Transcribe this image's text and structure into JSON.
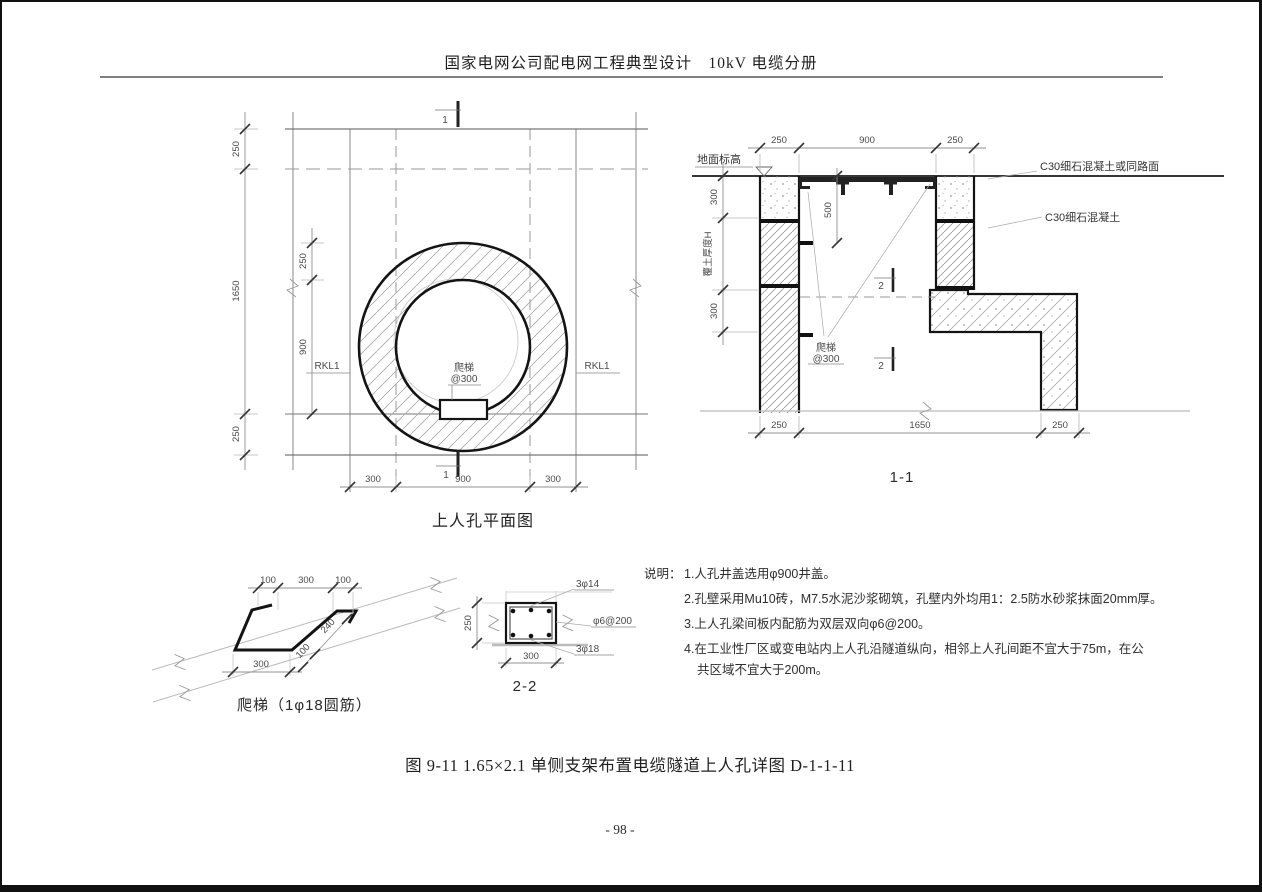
{
  "page": {
    "header_title": "国家电网公司配电网工程典型设计　10kV 电缆分册",
    "caption": "图 9-11 1.65×2.1 单侧支架布置电缆隧道上人孔详图 D-1-1-11",
    "page_number": "- 98 -"
  },
  "plan": {
    "title": "上人孔平面图",
    "section_marker": "1",
    "beam_left": "RKL1",
    "beam_right": "RKL1",
    "ladder_note_1": "爬梯",
    "ladder_note_2": "@300",
    "dims": {
      "outer_top": "250",
      "outer_height": "1650",
      "outer_bottom": "250",
      "wall_top": "250",
      "opening": "900",
      "bottom_left": "300",
      "bottom_mid": "900",
      "bottom_right": "300"
    }
  },
  "section_1_1": {
    "title": "1-1",
    "section_marker": "2",
    "ground_label": "地面标高",
    "surface_label": "C30细石混凝土或同路面",
    "concrete_label": "C30细石混凝土",
    "cover_label": "覆土厚度H",
    "ladder_note_1": "爬梯",
    "ladder_note_2": "@300",
    "dims": {
      "top_left": "250",
      "top_mid": "900",
      "top_right": "250",
      "left_top": "300",
      "left_bottom": "300",
      "inner": "500",
      "bottom_left": "250",
      "bottom_mid": "1650",
      "bottom_right": "250"
    }
  },
  "ladder_detail": {
    "title": "爬梯（1φ18圆筋）",
    "dims": {
      "top_left": "100",
      "top_mid": "300",
      "top_right": "100",
      "bottom": "300",
      "diag_small": "100",
      "diag_large": "240"
    }
  },
  "section_2_2": {
    "title": "2-2",
    "top_rebar": "3φ14",
    "stirrup": "φ6@200",
    "bottom_rebar": "3φ18",
    "dims": {
      "left": "250",
      "bottom": "300"
    }
  },
  "notes": {
    "heading": "说明：",
    "lines": [
      "1.人孔井盖选用φ900井盖。",
      "2.孔壁采用Mu10砖，M7.5水泥沙浆砌筑，孔壁内外均用1：2.5防水砂浆抹面20mm厚。",
      "3.上人孔梁间板内配筋为双层双向φ6@200。",
      "4.在工业性厂区或变电站内上人孔沿隧道纵向，相邻上人孔间距不宜大于75m，在公",
      "共区域不宜大于200m。"
    ]
  }
}
